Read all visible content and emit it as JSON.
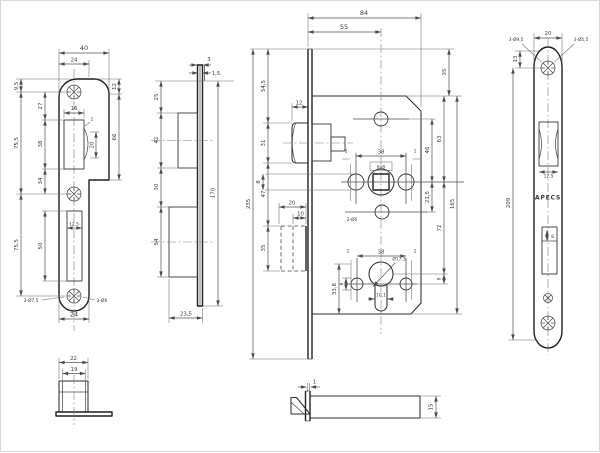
{
  "dims": {
    "v1": {
      "w40": "40",
      "w24": "24",
      "off95": "9,5",
      "s27": "27",
      "s755a": "75,5",
      "s38": "38",
      "s34": "34",
      "s755b": "75,5",
      "s50": "50",
      "r12": "12",
      "r66": "66",
      "slot16": "16",
      "off1": "1",
      "s20": "20",
      "slotw": "12,5",
      "holes_left": "3-Ø7,5",
      "holes_right": "3-Ø6",
      "wb24": "24"
    },
    "v2": {
      "t3": "3",
      "t15": "1,5",
      "s25": "25",
      "s42": "42",
      "s30": "30",
      "s54": "54",
      "h170": "170",
      "w235": "23,5"
    },
    "v3": {
      "w84": "84",
      "w55": "55",
      "h545": "54,5",
      "latch12": "12",
      "latch31": "31",
      "mid47": "47",
      "db35": "35",
      "db20": "20",
      "db10": "10",
      "h235": "235",
      "r35": "35",
      "r63": "63",
      "r46": "46",
      "r215": "21,5",
      "r72": "72",
      "r8": "8",
      "r165": "165",
      "cc38": "38",
      "t1l": "1",
      "t1r": "1",
      "sq": "8x8",
      "mid8": "8",
      "holes": "2-Ø6",
      "lc38": "38",
      "l1l": "1",
      "l1r": "1",
      "h338": "33,8",
      "low8": "8",
      "cyl": "Ø17,3",
      "w101": "10,1"
    },
    "v4": {
      "w20": "20",
      "h13": "13",
      "csk": "3-Ø9,5",
      "drl": "3-Ø5,5",
      "h209": "209",
      "brand": "APECS",
      "latchw": "12,5",
      "db8": "8"
    },
    "v5": {
      "w22": "22",
      "w19": "19"
    },
    "v6": {
      "g1": "1",
      "h15": "15"
    }
  }
}
